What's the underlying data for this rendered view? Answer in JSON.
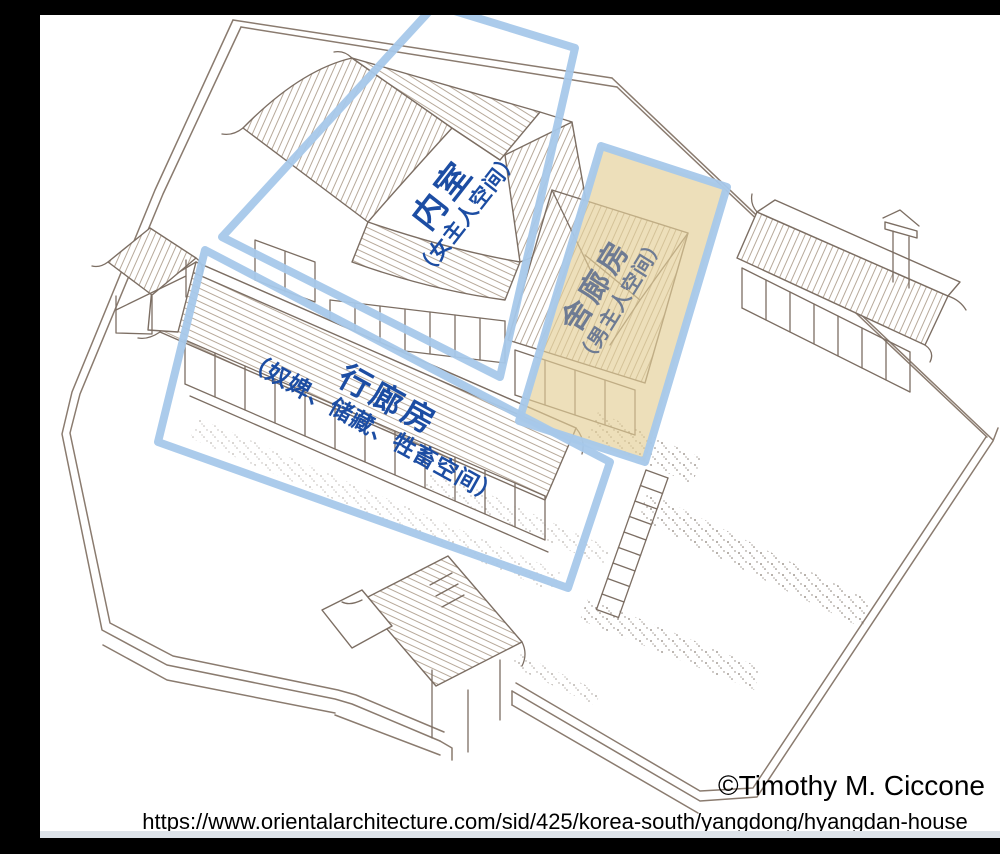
{
  "annotations": {
    "neishi": {
      "title": "内室",
      "subtitle": "（女主人空间）"
    },
    "shelangfang": {
      "title": "舍廊房",
      "subtitle": "（男主人空间）"
    },
    "xinglangfang": {
      "title": "行廊房",
      "subtitle": "（奴婢、储藏、牲畜空间）"
    }
  },
  "footer": {
    "credit": "©Timothy M. Ciccone",
    "url": "https://www.orientalarchitecture.com/sid/425/korea-south/yangdong/hyangdan-house"
  },
  "colors": {
    "box_outline_blue": "#a6c8ea",
    "label_blue": "#1c4da3",
    "label_muted_on_highlight": "#6e7b93",
    "highlight_yellow": "#e3cf96",
    "drawing_ink": "#7c6e63",
    "letterbox_black": "#000000"
  }
}
